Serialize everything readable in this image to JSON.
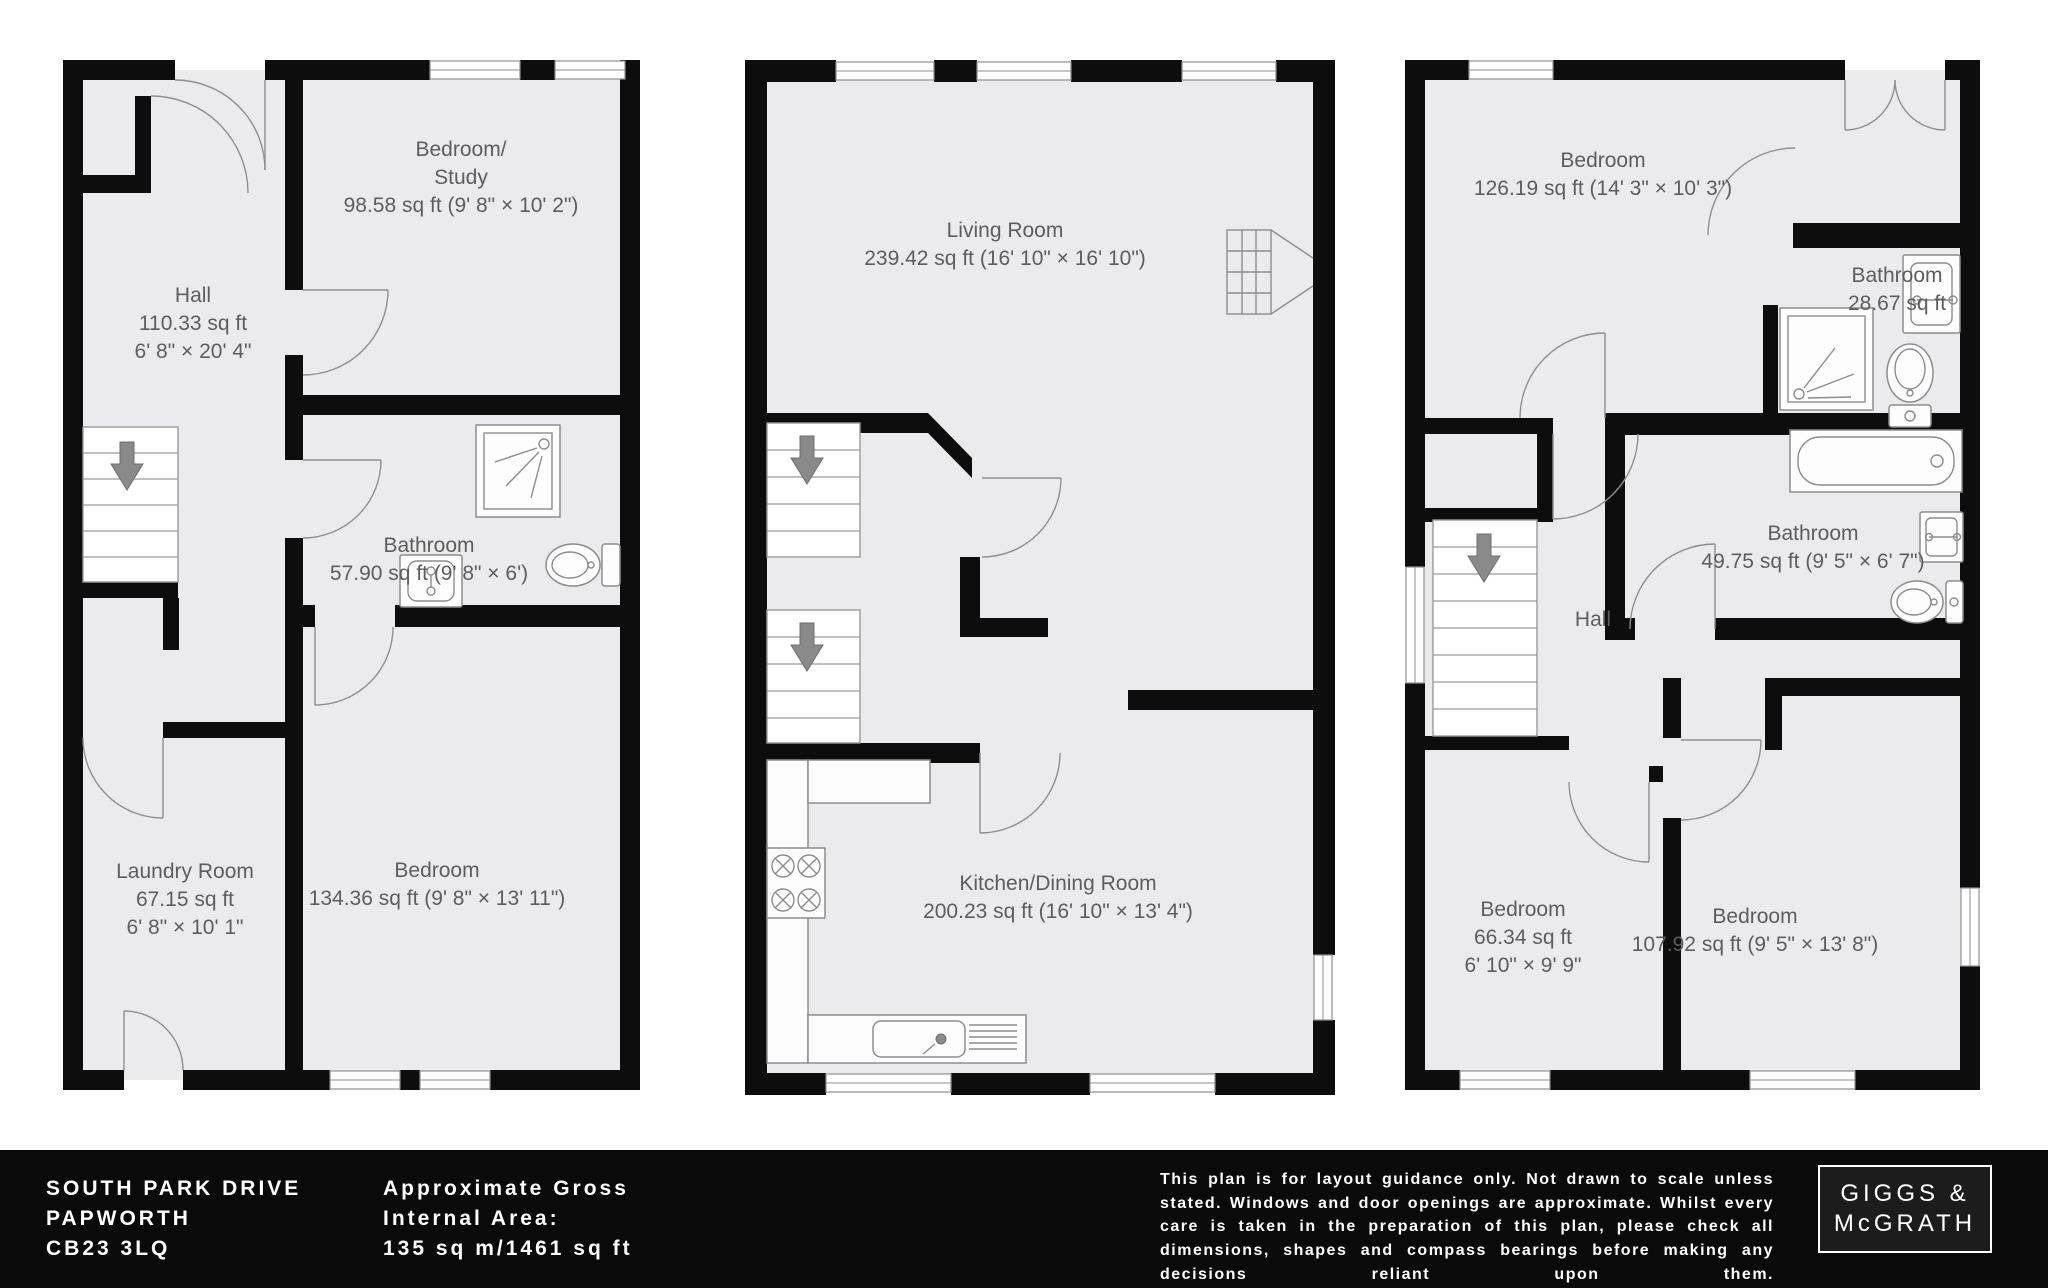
{
  "meta": {
    "type": "floorplan-sheet",
    "colors": {
      "floor_fill": "#ebebed",
      "wall": "#0d0d0d",
      "label_text": "#5d5d5d",
      "footer_bg": "#0a0a0a",
      "footer_text": "#ffffff"
    }
  },
  "plans": [
    {
      "id": "left-plan",
      "rooms": [
        {
          "lines": [
            "Bedroom/",
            "Study",
            "98.58 sq ft (9' 8\" × 10' 2\")"
          ]
        },
        {
          "lines": [
            "Hall",
            "110.33 sq ft",
            "6' 8\" × 20' 4\""
          ]
        },
        {
          "lines": [
            "Bathroom",
            "57.90 sq ft (9' 8\" × 6')"
          ]
        },
        {
          "lines": [
            "Laundry Room",
            "67.15 sq ft",
            "6' 8\" × 10' 1\""
          ]
        },
        {
          "lines": [
            "Bedroom",
            "134.36 sq ft (9' 8\" × 13' 11\")"
          ]
        }
      ],
      "fixtures": [
        "stairs-down",
        "shower",
        "sink",
        "toilet"
      ]
    },
    {
      "id": "middle-plan",
      "rooms": [
        {
          "lines": [
            "Living Room",
            "239.42 sq ft (16' 10\" × 16' 10\")"
          ]
        },
        {
          "lines": [
            "Kitchen/Dining Room",
            "200.23 sq ft (16' 10\" × 13' 4\")"
          ]
        }
      ],
      "fixtures": [
        "stairs-down",
        "stairs-down",
        "fireplace",
        "hob",
        "kitchen-sink"
      ]
    },
    {
      "id": "right-plan",
      "rooms": [
        {
          "lines": [
            "Bedroom",
            "126.19 sq ft (14' 3\" × 10' 3\")"
          ]
        },
        {
          "lines": [
            "Bathroom",
            "28.67 sq ft"
          ]
        },
        {
          "lines": [
            "Bathroom",
            "49.75 sq ft (9' 5\" × 6' 7\")"
          ]
        },
        {
          "lines": [
            "Hall"
          ]
        },
        {
          "lines": [
            "Bedroom",
            "66.34 sq ft",
            "6' 10\" × 9' 9\""
          ]
        },
        {
          "lines": [
            "Bedroom",
            "107.92 sq ft (9' 5\" × 13' 8\")"
          ]
        }
      ],
      "fixtures": [
        "stairs-down",
        "shower",
        "toilet",
        "sink",
        "bath",
        "sink",
        "toilet"
      ]
    }
  ],
  "footer": {
    "address_lines": [
      "SOUTH PARK DRIVE",
      "PAPWORTH",
      "CB23 3LQ"
    ],
    "area_lines": [
      "Approximate Gross",
      "Internal Area:",
      "135 sq m/1461 sq ft"
    ],
    "disclaimer": "This plan is for layout guidance only. Not drawn to scale unless stated. Windows and door openings are approximate. Whilst every care is taken in the preparation of this plan, please check all dimensions, shapes and compass bearings before making any decisions reliant upon them.",
    "logo_lines": [
      "GIGGS &",
      "McGRATH"
    ]
  }
}
